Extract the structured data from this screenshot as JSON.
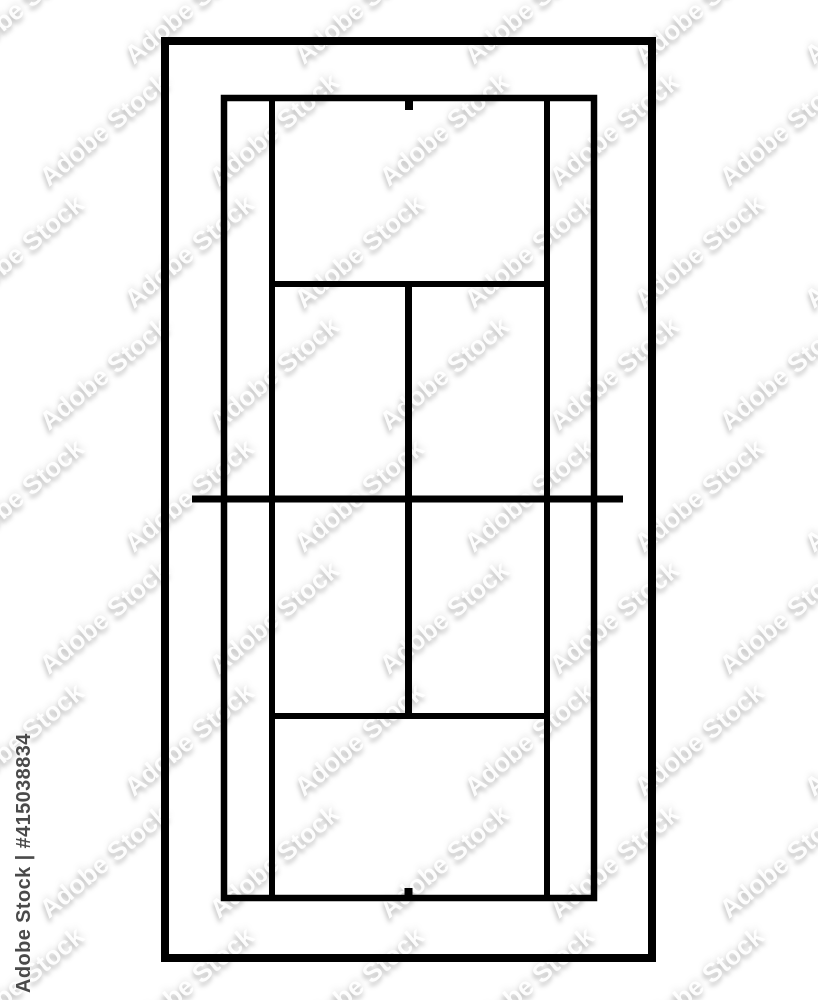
{
  "image": {
    "background_color": "#ffffff",
    "width": 818,
    "height": 1000
  },
  "watermark": {
    "tile_text": "Adobe Stock",
    "credit_text": "Adobe Stock | #415038834",
    "credit_color": "#4a4a4a"
  },
  "diagram": {
    "title": "tennis-court-top-view",
    "line_color": "#000000",
    "background_color": "#ffffff",
    "rects": [
      {
        "name": "outer-border",
        "x": 165,
        "y": 41,
        "w": 487,
        "h": 917,
        "stroke_width": 8
      },
      {
        "name": "court-boundary",
        "x": 224,
        "y": 98,
        "w": 370,
        "h": 800,
        "stroke_width": 6.5
      }
    ],
    "lines": [
      {
        "name": "singles-sideline-left",
        "x1": 272,
        "y1": 95,
        "x2": 272,
        "y2": 901,
        "width": 6
      },
      {
        "name": "singles-sideline-right",
        "x1": 547,
        "y1": 95,
        "x2": 547,
        "y2": 901,
        "width": 6
      },
      {
        "name": "service-line-top",
        "x1": 269,
        "y1": 284,
        "x2": 550,
        "y2": 284,
        "width": 6
      },
      {
        "name": "service-line-bottom",
        "x1": 269,
        "y1": 716,
        "x2": 550,
        "y2": 716,
        "width": 6
      },
      {
        "name": "center-service-line",
        "x1": 408.5,
        "y1": 284,
        "x2": 408.5,
        "y2": 716,
        "width": 7
      },
      {
        "name": "net-line",
        "x1": 192,
        "y1": 499,
        "x2": 623,
        "y2": 499,
        "width": 7
      },
      {
        "name": "center-mark-top",
        "x1": 409,
        "y1": 98,
        "x2": 409,
        "y2": 110,
        "width": 8
      },
      {
        "name": "center-mark-bottom",
        "x1": 408.5,
        "y1": 888,
        "x2": 408.5,
        "y2": 898,
        "width": 8
      }
    ]
  },
  "watermark_grid": {
    "rows": 9,
    "cols": 6,
    "col_step": 170,
    "row_step": 122,
    "odd_row_offset": 85,
    "x_start": -60,
    "y_start": -8
  }
}
